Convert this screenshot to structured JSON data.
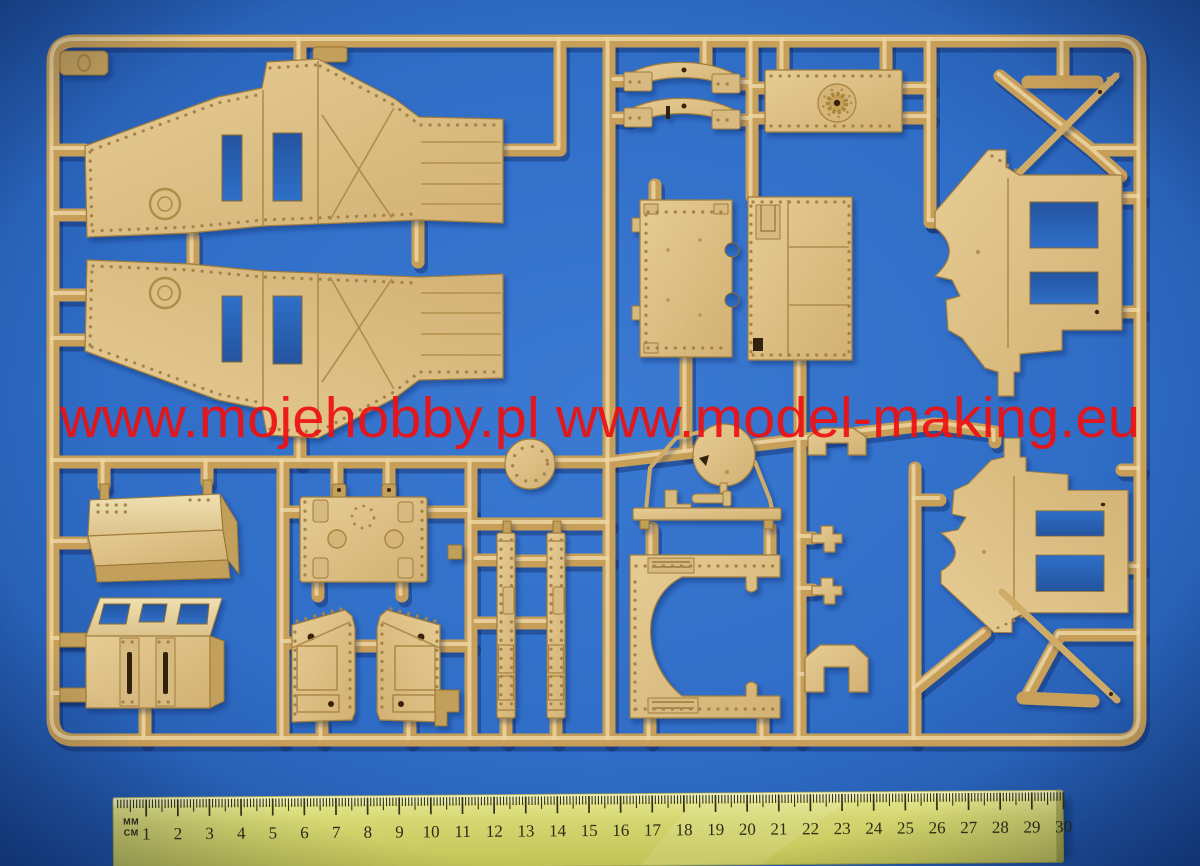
{
  "scene": {
    "description": "Photograph of a tan injection-molded plastic model-kit sprue (armored vehicle parts) lying on a blue studio background, with a 30 cm ruler placed below for scale",
    "background_color": "#2f6dc6",
    "vignette_color": "#15377c"
  },
  "watermark": {
    "text": "www.mojehobby.pl www.model-making.eu",
    "color": "#ee1111"
  },
  "sprue": {
    "plastic_color": "#c79f58",
    "highlight_color": "#ecd5a2",
    "part_face_color": "#dcc088",
    "corner_tag_mark": "0",
    "parts": [
      {
        "id": "hull-side-panel-a",
        "label": "Riveted hull side panel (upper)"
      },
      {
        "id": "hull-side-panel-b",
        "label": "Riveted hull side panel (lower, mirrored)"
      },
      {
        "id": "arc-bracket-a",
        "label": "Curved suspension arc bracket"
      },
      {
        "id": "arc-bracket-b",
        "label": "Curved suspension arc bracket with slot"
      },
      {
        "id": "drive-plate",
        "label": "Transmission plate with toothed sprocket hub"
      },
      {
        "id": "axle-bar",
        "label": "Short axle bar"
      },
      {
        "id": "spear-rod",
        "label": "Long pointed brace rod"
      },
      {
        "id": "sponson-panel-upper",
        "label": "Sponson panel with two rectangular openings (upper right)"
      },
      {
        "id": "sponson-panel-lower",
        "label": "Sponson panel with two rectangular openings (lower right)"
      },
      {
        "id": "floor-panel-a",
        "label": "Rectangular floor panel with edge notches"
      },
      {
        "id": "floor-panel-b",
        "label": "Rectangular bulkhead panel with hatch bracket"
      },
      {
        "id": "round-hatch",
        "label": "Riveted circular hatch disc"
      },
      {
        "id": "roof-panel",
        "label": "Angled roof plate with rivet rows"
      },
      {
        "id": "cab-box",
        "label": "Cab box with three vision ports and twin slotted doors"
      },
      {
        "id": "fuel-tank",
        "label": "Tank box with filler circles and corner pads"
      },
      {
        "id": "door-panel-a",
        "label": "Riveted access door (left)"
      },
      {
        "id": "door-panel-b",
        "label": "Riveted access door (right, mirrored)"
      },
      {
        "id": "track-rail-a",
        "label": "Riveted rail strip"
      },
      {
        "id": "track-rail-b",
        "label": "Riveted rail strip"
      },
      {
        "id": "gun-mount",
        "label": "Machine-gun mount with round shield disc"
      },
      {
        "id": "c-bracket",
        "label": "C-shaped mounting frame with hinge strips"
      },
      {
        "id": "clip-a",
        "label": "Small cross clip"
      },
      {
        "id": "clip-b",
        "label": "Small cross clip"
      },
      {
        "id": "angle-bracket-a",
        "label": "Stepped staple bracket"
      },
      {
        "id": "angle-bracket-b",
        "label": "Stepped staple bracket (tall)"
      },
      {
        "id": "push-rod",
        "label": "Long diagonal push rod"
      },
      {
        "id": "tie-bar",
        "label": "Short tie bar"
      },
      {
        "id": "corner-tag",
        "label": "Sprue identification tag"
      }
    ]
  },
  "ruler": {
    "unit_label_top": "MM",
    "unit_label_bottom": "CM",
    "length_cm": 30,
    "numbers": [
      1,
      2,
      3,
      4,
      5,
      6,
      7,
      8,
      9,
      10,
      11,
      12,
      13,
      14,
      15,
      16,
      17,
      18,
      19,
      20,
      21,
      22,
      23,
      24,
      25,
      26,
      27,
      28,
      29,
      30
    ],
    "body_color": "#d6d772",
    "tick_color": "#31321a"
  }
}
